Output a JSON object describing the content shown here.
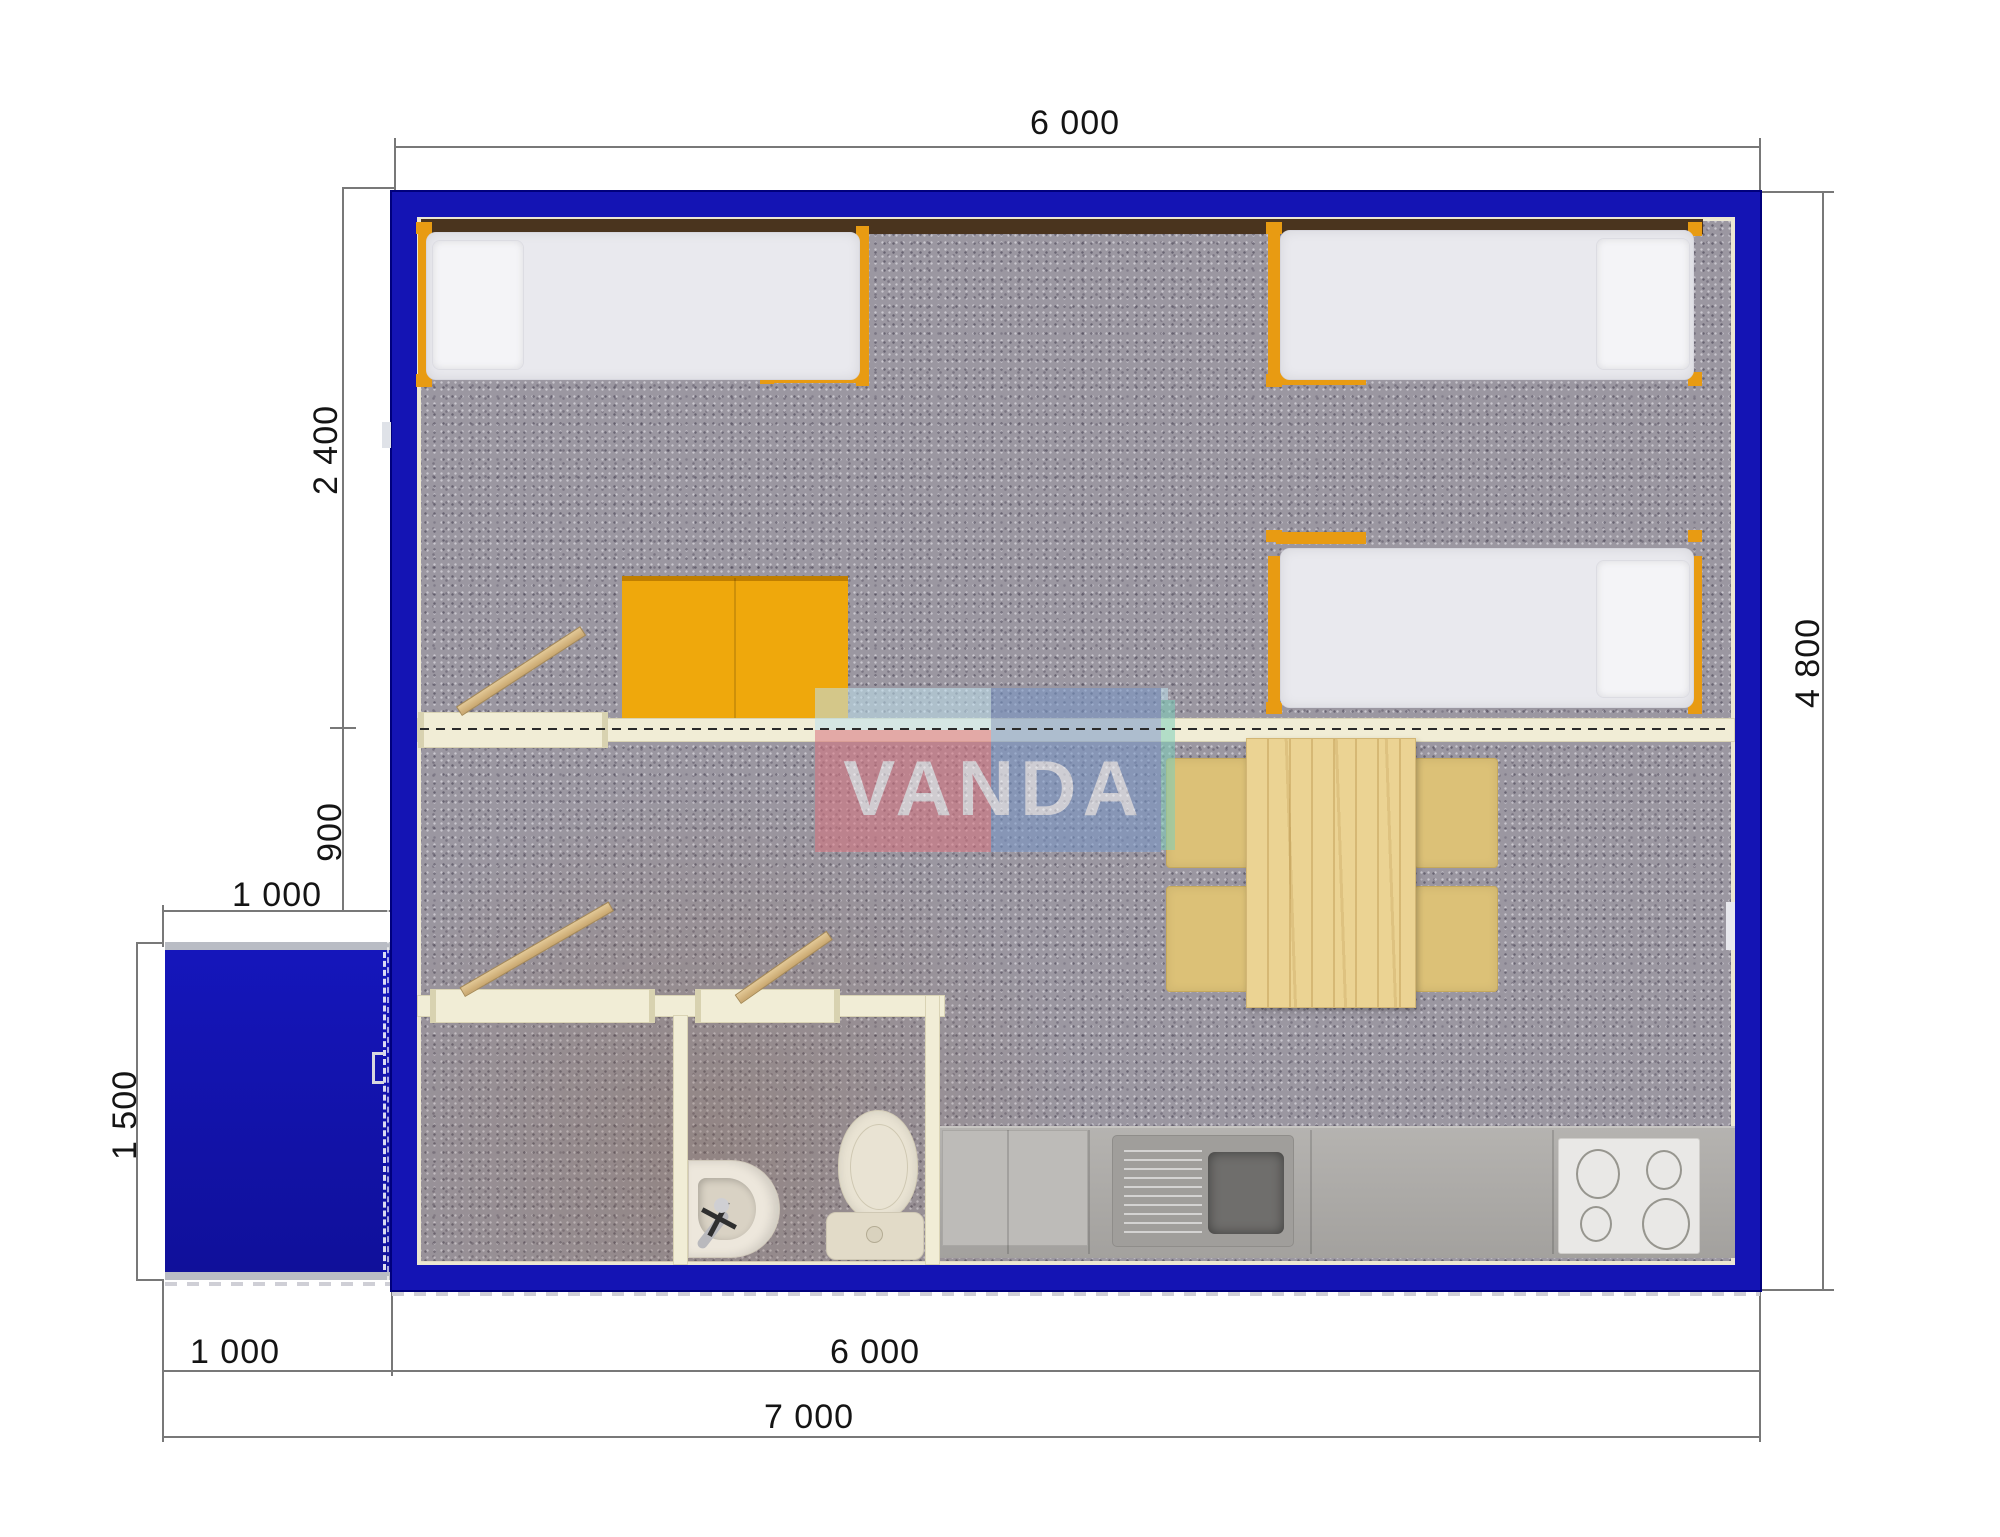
{
  "document": {
    "type": "floor-plan-render",
    "description": "Top-view 3D floor plan of a modular cabin with dimension lines"
  },
  "watermark": {
    "text": "VANDA"
  },
  "dimensions": {
    "top_width": "6 000",
    "bedroom_depth": "2 400",
    "hall_depth": "900",
    "porch_width_top": "1 000",
    "porch_depth": "1 500",
    "right_height": "4 800",
    "porch_width_bottom": "1 000",
    "main_width_bottom": "6 000",
    "total_width": "7 000"
  },
  "rooms": {
    "bedroom": "sleeping area with three single beds and wardrobe",
    "living": "dining area with table and four chairs",
    "shower_room": "empty shower room",
    "wc": "toilet with washbasin",
    "kitchen": "counter with sink, drainboard and 4-burner hob",
    "porch": "entrance porch"
  },
  "colors": {
    "wall_blue": "#1414b4",
    "frame_orange": "#e89b12",
    "wardrobe_orange": "#efa80c",
    "partition_cream": "#f1edd6",
    "carpet_grey": "#9b97a1",
    "counter_grey": "#aba9a6",
    "table_pine": "#ebd393",
    "dim_line_grey": "#787878",
    "logo_red": "#d9737f",
    "logo_blue": "#7796c8",
    "logo_lightblue": "#bfe2ef"
  }
}
